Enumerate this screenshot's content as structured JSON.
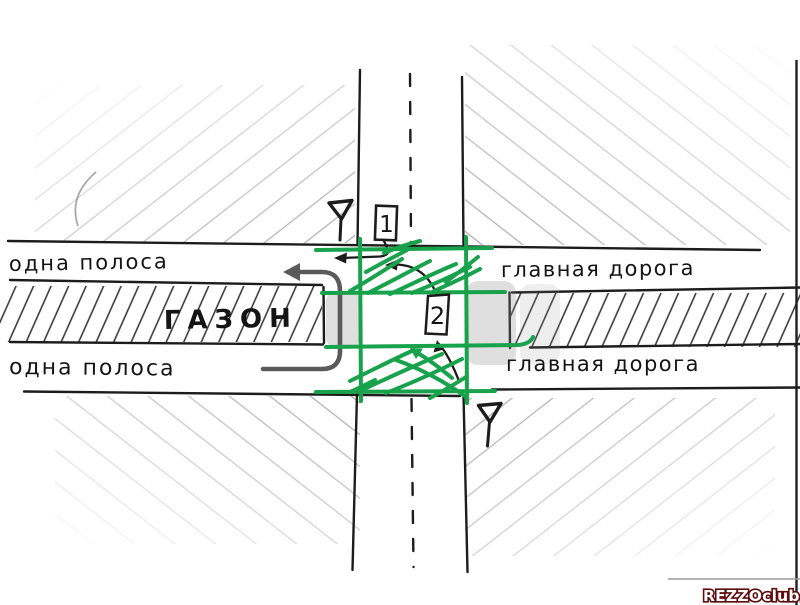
{
  "labels": {
    "lane_top": "одна полоса",
    "lane_bottom": "одна полоса",
    "main_road_top": "главная дорога",
    "main_road_bottom": "главная дорога",
    "median": "ГАЗОН"
  },
  "vehicles": {
    "v1": "1",
    "v2": "2"
  },
  "watermark": {
    "text": "REZZOclub.ru"
  },
  "colors": {
    "ink": "#1c1c1c",
    "pencil": "#949494",
    "green": "#17a24b",
    "gray_path": "#5a5a5a",
    "highlight": "rgba(140,140,140,0.28)",
    "watermark_fill": "#ffffff",
    "watermark_outline": "#5c0d0d"
  }
}
